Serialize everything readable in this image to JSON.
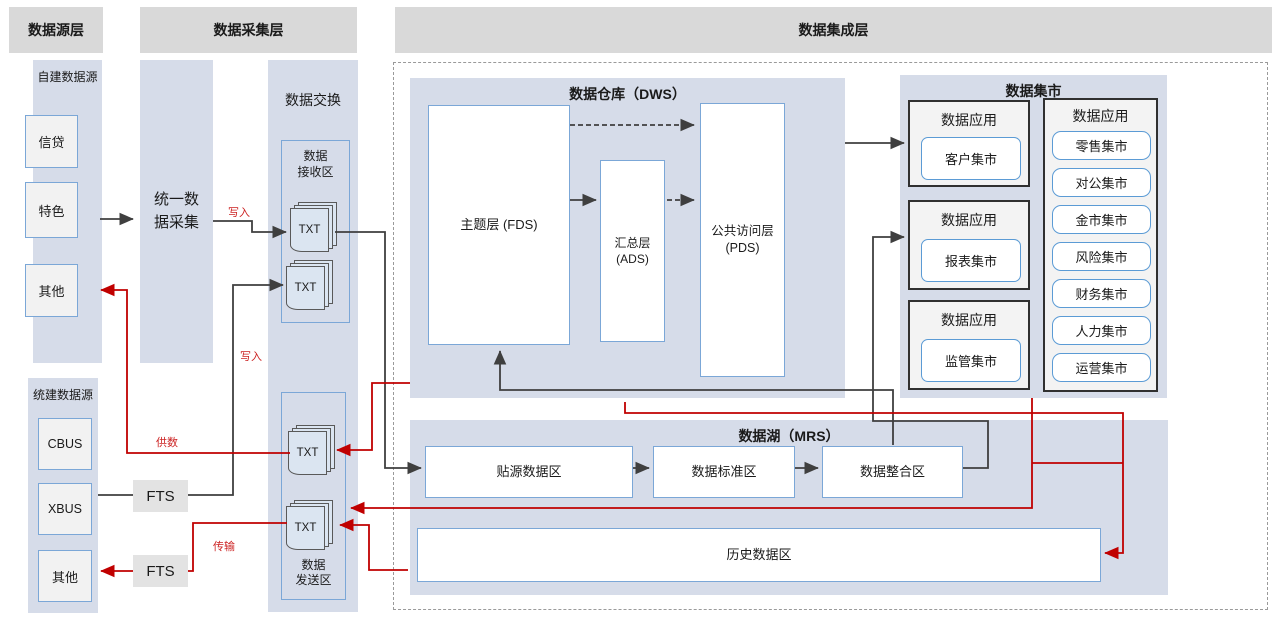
{
  "layers": {
    "source": "数据源层",
    "collection": "数据采集层",
    "integration": "数据集成层"
  },
  "source_panel": {
    "self_built_title": "自建数据源",
    "self_built_items": [
      "信贷",
      "特色",
      "其他"
    ],
    "unified_title": "统建数据源",
    "unified_items": [
      "CBUS",
      "XBUS",
      "其他"
    ]
  },
  "collection_panel": {
    "unified_collection": [
      "统一数",
      "据采集"
    ],
    "fts1": "FTS",
    "fts2": "FTS"
  },
  "exchange_panel": {
    "title": "数据交换",
    "receive_zone": [
      "数据",
      "接收区"
    ],
    "send_zone": [
      "数据",
      "发送区"
    ],
    "txt_label": "TXT"
  },
  "flow_labels": {
    "write1": "写入",
    "write2": "写入",
    "supply": "供数",
    "transfer": "传输"
  },
  "dws": {
    "title": "数据仓库（DWS）",
    "fds": "主题层 (FDS)",
    "ads": [
      "汇总层",
      "(ADS)"
    ],
    "pds": [
      "公共访问层",
      "(PDS)"
    ]
  },
  "mart": {
    "title": "数据集市",
    "app_label": "数据应用",
    "left_apps": [
      "客户集市",
      "报表集市",
      "监管集市"
    ],
    "right_apps": [
      "零售集市",
      "对公集市",
      "金市集市",
      "风险集市",
      "财务集市",
      "人力集市",
      "运营集市"
    ]
  },
  "mrs": {
    "title": "数据湖（MRS）",
    "zones": [
      "贴源数据区",
      "数据标准区",
      "数据整合区"
    ],
    "history": "历史数据区"
  },
  "colors": {
    "red_line": "#c00000",
    "black_line": "#3f3f3f",
    "panel_fill": "#d6dce9",
    "header_fill": "#d9d9d9"
  }
}
